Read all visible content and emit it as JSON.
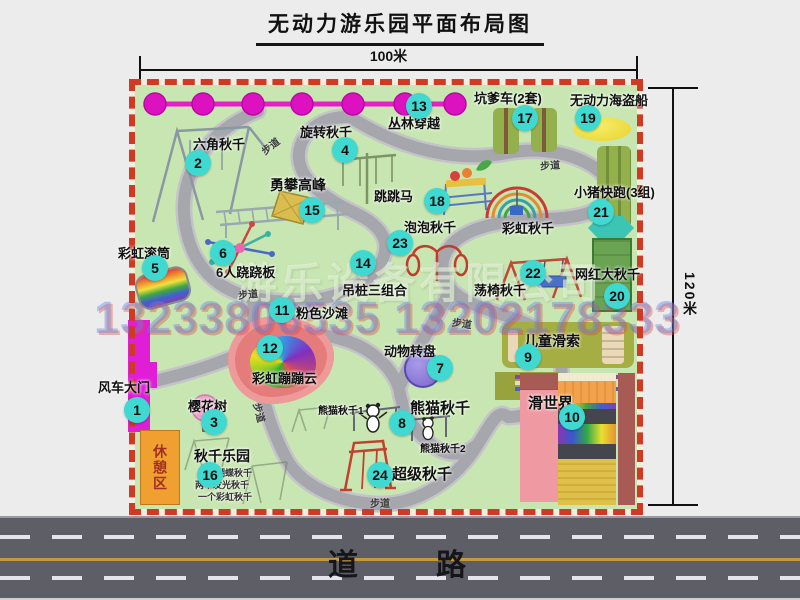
{
  "title": "无动力游乐园平面布局图",
  "dimensions": {
    "top": "100米",
    "right": "120米"
  },
  "road": {
    "label": "道　　路"
  },
  "watermark": {
    "company": "游乐设备有限公司",
    "phone": "13233806535 13202178333"
  },
  "extras": {
    "path_label": "步道",
    "rest_area": "休憩区",
    "rainbow_swing": "彩虹秋千",
    "panda1": "熊猫秋千1",
    "panda2": "熊猫秋千2",
    "swing_park_lines": [
      "两个蝴蝶秋千",
      "两个发光秋千",
      "一个彩虹秋千"
    ]
  },
  "attractions": [
    {
      "num": "1",
      "name": "风车大门"
    },
    {
      "num": "2",
      "name": "六角秋千"
    },
    {
      "num": "3",
      "name": "樱花树"
    },
    {
      "num": "4",
      "name": "旋转秋千"
    },
    {
      "num": "5",
      "name": "彩虹滚筒"
    },
    {
      "num": "6",
      "name": "6人跷跷板"
    },
    {
      "num": "7",
      "name": "动物转盘"
    },
    {
      "num": "8",
      "name": "熊猫秋千"
    },
    {
      "num": "9",
      "name": "儿童滑索"
    },
    {
      "num": "10",
      "name": "滑世界"
    },
    {
      "num": "11",
      "name": "粉色沙滩"
    },
    {
      "num": "12",
      "name": "彩虹蹦蹦云"
    },
    {
      "num": "13",
      "name": "丛林穿越"
    },
    {
      "num": "14",
      "name": "吊桩三组合"
    },
    {
      "num": "15",
      "name": "勇攀高峰"
    },
    {
      "num": "16",
      "name": "秋千乐园"
    },
    {
      "num": "17",
      "name": "坑爹车(2套)"
    },
    {
      "num": "18",
      "name": "跳跳马"
    },
    {
      "num": "19",
      "name": "无动力海盗船"
    },
    {
      "num": "20",
      "name": "网红大秋千"
    },
    {
      "num": "21",
      "name": "小猪快跑(3组)"
    },
    {
      "num": "22",
      "name": "荡椅秋千"
    },
    {
      "num": "23",
      "name": "泡泡秋千"
    },
    {
      "num": "24",
      "name": "超级秋千"
    }
  ],
  "colors": {
    "marker": "#3fd9d2",
    "map_green": "#c8e6b2",
    "border_red": "#ce3a24",
    "road_gray": "#5e5e67",
    "gate_magenta": "#df1ed6"
  }
}
